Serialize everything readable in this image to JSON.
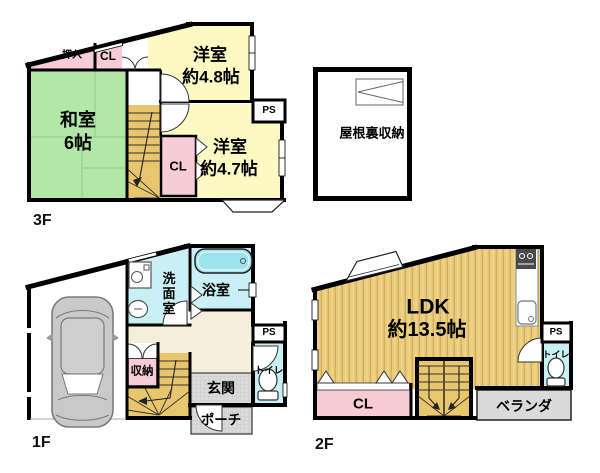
{
  "floors": {
    "f3": {
      "label": "3F",
      "washitsu_1": "和室",
      "washitsu_2": "6帖",
      "yoshitsu48_1": "洋室",
      "yoshitsu48_2": "約4.8帖",
      "yoshitsu47_1": "洋室",
      "yoshitsu47_2": "約4.7帖",
      "oshiire": "押入",
      "cl_top": "CL",
      "cl_mid": "CL",
      "ps": "PS"
    },
    "attic": {
      "label": "屋根裏収納"
    },
    "f1": {
      "label": "1F",
      "senmenshitsu": "洗面室",
      "yokushitsu": "浴室",
      "shunou": "収納",
      "genkan": "玄関",
      "porch": "ポーチ",
      "toilet": "トイレ",
      "ps": "PS"
    },
    "f2": {
      "label": "2F",
      "ldk_1": "LDK",
      "ldk_2": "約13.5帖",
      "cl": "CL",
      "veranda": "ベランダ",
      "toilet": "トイレ",
      "ps": "PS"
    }
  },
  "colors": {
    "tatami_green": "#b3e7a7",
    "western_yellow": "#fdf9c3",
    "closet_pink": "#f7ccd6",
    "stair_tan": "#e8c66e",
    "wet_room_cyan": "#c9f1f5",
    "bathtub_cyan": "#9de2ec",
    "hall_cream": "#f4eedb",
    "gray_area": "#dadada",
    "ldk_floor": "#eacc7e",
    "wall": "#000000"
  }
}
